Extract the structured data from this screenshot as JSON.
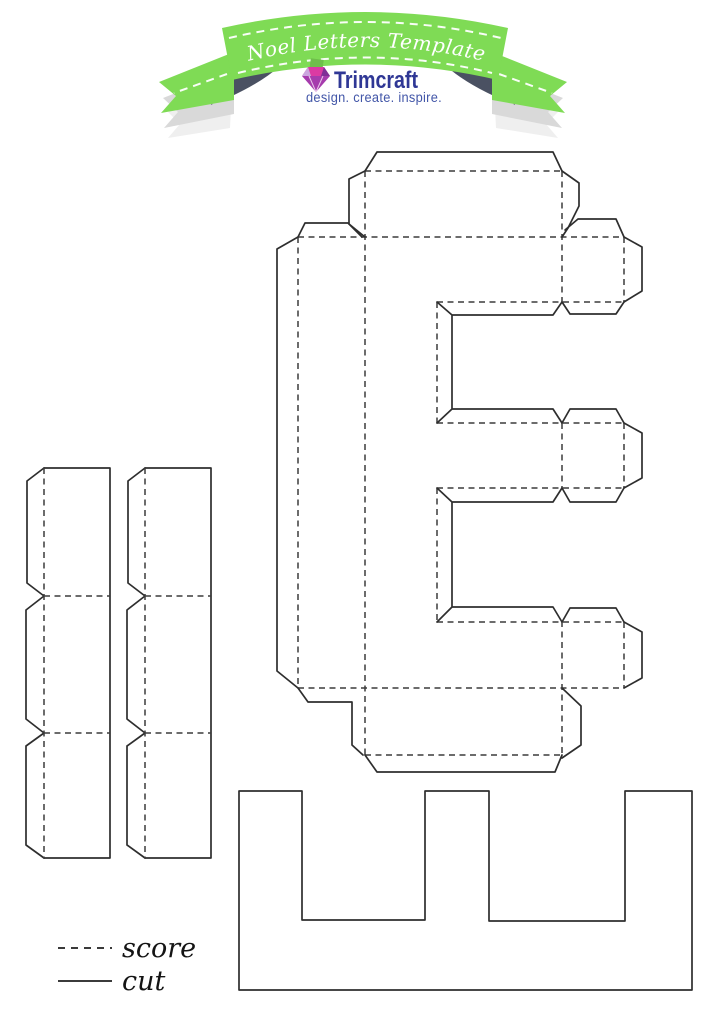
{
  "banner": {
    "title": "3D Noel Letters Template - E",
    "ribbon_green": "#7FDB55",
    "fold_navy": "#4A5162",
    "shadow_gray": "#D9D9D9",
    "shadow_pale": "#EFEFEF",
    "stitch_white": "#FFFFFF"
  },
  "logo": {
    "name": "Trimcraft",
    "tagline": "design. create. inspire.",
    "name_color": "#2F3795",
    "tagline_color": "#4256A8",
    "diamond_lavender": "#CBA6DE",
    "diamond_magenta": "#DB3AA3",
    "diamond_purple": "#7F2F96",
    "diamond_pavilion": "#A63BAD",
    "diamond_leaf_green": "#6FBF4B"
  },
  "legend": {
    "score_label": "score",
    "cut_label": "cut"
  },
  "lines": {
    "cut_color": "#2e2e2e",
    "score_color": "#3c3c3c"
  }
}
